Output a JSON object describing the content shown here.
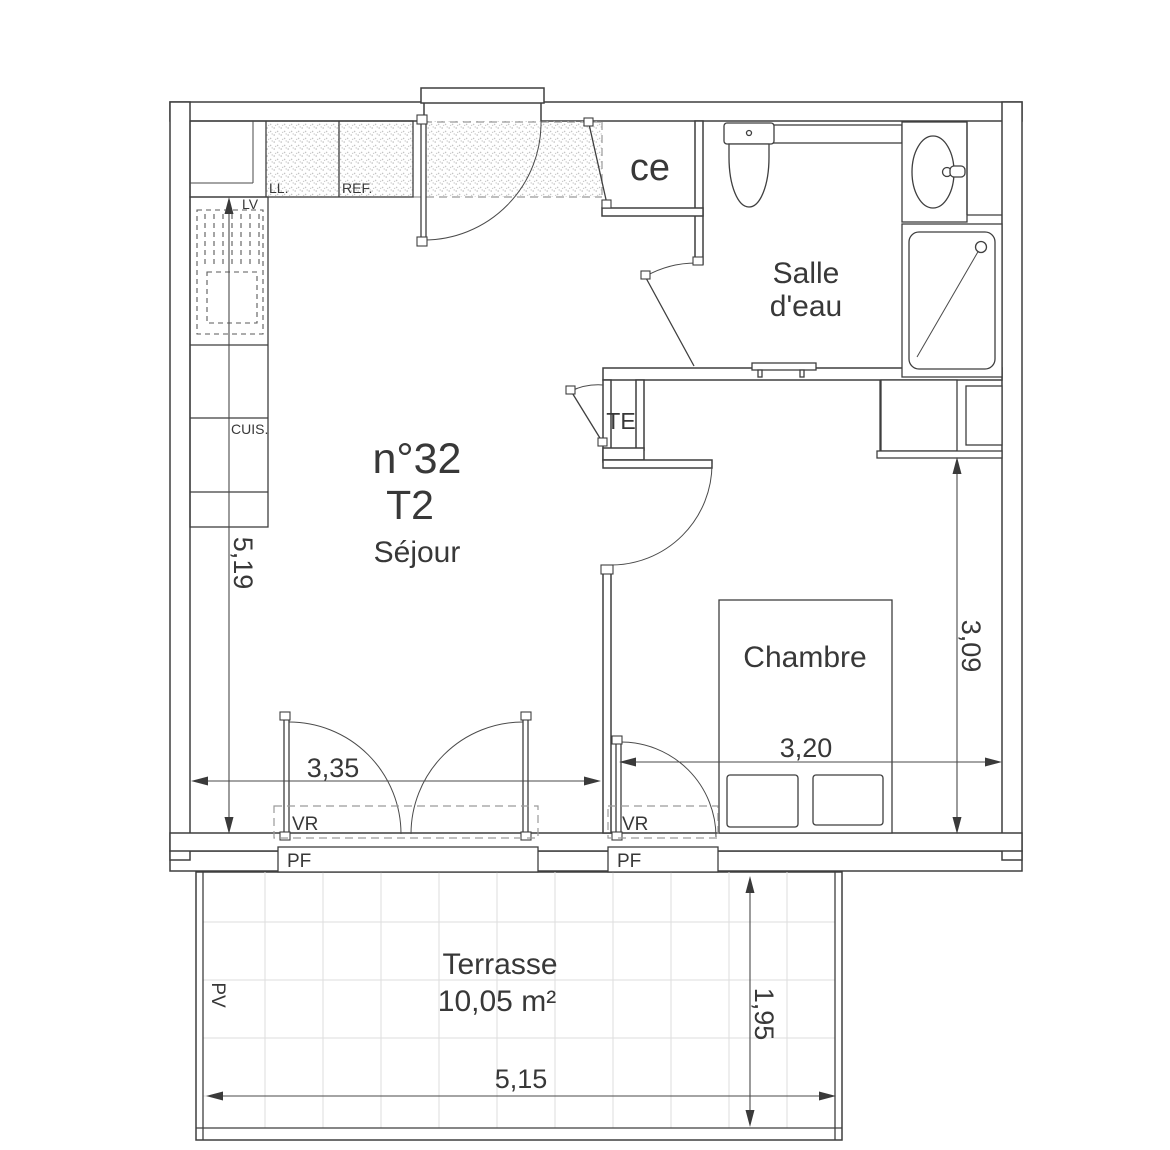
{
  "unit": {
    "number": "n°32",
    "type": "T2"
  },
  "rooms": {
    "sejour": "Séjour",
    "chambre": "Chambre",
    "salle_eau_1": "Salle",
    "salle_eau_2": "d'eau",
    "terrasse": "Terrasse",
    "terrasse_area": "10,05 m²",
    "ce": "ce",
    "te": "TE"
  },
  "kitchen": {
    "lv": "LV",
    "ll": "LL.",
    "ref": "REF.",
    "cuis": "CUIS."
  },
  "openings": {
    "pf": "PF",
    "vr": "VR",
    "pv": "PV"
  },
  "dimensions": {
    "sejour_width": "3,35",
    "left_height": "5,19",
    "chambre_width": "3,20",
    "chambre_height": "3,09",
    "terrasse_width": "5,15",
    "terrasse_depth": "1,95"
  },
  "colors": {
    "line": "#3f3f3f",
    "dashed": "#9a9a9a",
    "tile_grid": "#dedede",
    "stipple": "#bdbdbd",
    "text": "#383838"
  }
}
